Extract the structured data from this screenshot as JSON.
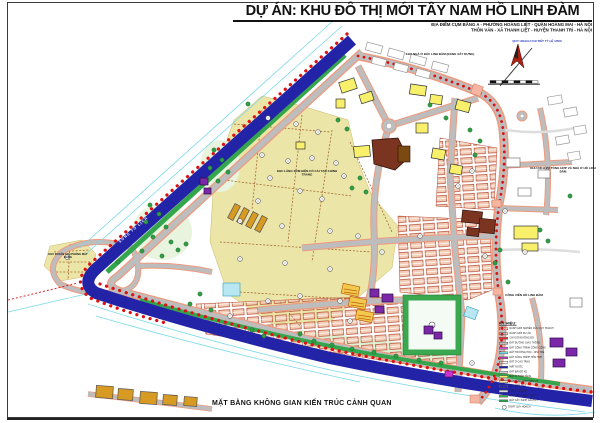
{
  "page": {
    "title": "DỰ ÁN: KHU ĐÔ THỊ MỚI TÂY NAM HỒ LINH ĐÀM",
    "subtitle_line1": "ĐỊA ĐIỂM CỤM BẰNG A - PHƯỜNG HOÀNG LIỆT - QUẬN HOÀNG MAI - HÀ NỘI",
    "subtitle_line2": "THÔN VĂN - XÃ THANH LIỆT - HUYỆN THANH TRÌ - HÀ NỘI",
    "caption": "MẶT BẰNG KHÔNG GIAN KIẾN TRÚC CẢNH QUAN"
  },
  "map": {
    "river_label": "SÔNG TÔ LỊCH",
    "annotations": {
      "north_area": "KHU NHÀ Ở BẮC LINH ĐÀM (ĐANG XÂY DỰNG)",
      "drawing_note": "QUY HOẠCH CHI TIẾT TỶ LỆ 1/500",
      "east_area": "KHU DỊCH VỤ TỔNG HỢP VÀ NHÀ Ở HỒ LINH ĐÀM",
      "southeast_area": "CÔNG VIÊN HỒ LINH ĐÀM",
      "village_area": "KHU LÀNG XÓM HIỆN CÓ CẢI TẠO CHỈNH TRANG",
      "west_area": "KHU DI DÂN GIẢI PHÓNG MẶT BẰNG"
    },
    "colors": {
      "river": "#2323a8",
      "boundary_red": "#dd1111",
      "road_gray": "#bdbdbd",
      "road_edge": "#ef9a7e",
      "village_land": "#ece5a8",
      "green_space": "#35a64d",
      "highrise_yellow": "#f8ef6a",
      "lowrise_row": "#f2cdb6"
    }
  },
  "legend": {
    "title": "KÝ HIỆU:",
    "items": [
      {
        "label": "RANH GIỚI NGHIÊN CỨU QUY HOẠCH",
        "color": "#ffffff",
        "style": "dash"
      },
      {
        "label": "RANH GIỚI DỰ ÁN",
        "color": "#ffffff",
        "style": "outline"
      },
      {
        "label": "CHỈ GIỚI ĐƯỜNG ĐỎ",
        "color": "#e03030",
        "style": "fill"
      },
      {
        "label": "ĐẤT ĐƯỜNG GIAO THÔNG",
        "color": "#bdbdbd",
        "style": "fill"
      },
      {
        "label": "ĐẤT CÔNG TRÌNH CÔNG CỘNG",
        "color": "#d24bd2",
        "style": "fill"
      },
      {
        "label": "ĐẤT TRƯỜNG HỌC - NHÀ TRẺ",
        "color": "#7ad9e8",
        "style": "fill"
      },
      {
        "label": "ĐẤT CÔNG TRÌNH HỖN HỢP",
        "color": "#b03ab0",
        "style": "fill"
      },
      {
        "label": "ĐẤT Ở CAO TẦNG",
        "color": "#ffffff",
        "style": "outline"
      },
      {
        "label": "MẶT NƯỚC",
        "color": "#2323a8",
        "style": "fill"
      },
      {
        "label": "ĐẤT BÃI ĐỖ XE",
        "color": "#d0d0d0",
        "style": "fill"
      },
      {
        "label": "ĐẤT Ở THẤP TẦNG",
        "color": "#f8ef6a",
        "style": "fill"
      },
      {
        "label": "ĐẤT LÀNG XÓM HIỆN CÓ",
        "color": "#ece5a8",
        "style": "fill"
      },
      {
        "label": "ĐẤT BIỆT THỰ",
        "color": "#ffffff",
        "style": "outline"
      },
      {
        "label": "ĐẤT CƠ QUAN",
        "color": "#d9d9d9",
        "style": "fill"
      },
      {
        "label": "ĐẤT CÂY XANH - TDTT",
        "color": "#41b054",
        "style": "fill"
      },
      {
        "label": "ĐẤT CÂY XANH CÁCH LY",
        "color": "#2f9e44",
        "style": "fill"
      }
    ],
    "note": "Ô ĐẤT QUY HOẠCH"
  }
}
